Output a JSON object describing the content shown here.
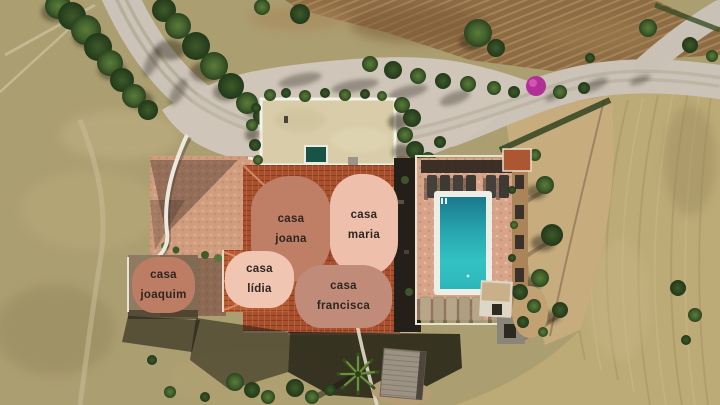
{
  "labels": [
    {
      "id": "casa-joana",
      "line1": "casa",
      "line2": "joana",
      "bg": "#bf7e66",
      "text_color": "#2e2620"
    },
    {
      "id": "casa-maria",
      "line1": "casa",
      "line2": "maria",
      "bg": "#eec0ac",
      "text_color": "#2e2620"
    },
    {
      "id": "casa-joaquim",
      "line1": "casa",
      "line2": "joaquim",
      "bg": "#bd7c64",
      "text_color": "#2e2620"
    },
    {
      "id": "casa-lidia",
      "line1": "casa",
      "line2": "lídia",
      "bg": "#f0c5b1",
      "text_color": "#2e2620"
    },
    {
      "id": "casa-francisca",
      "line1": "casa",
      "line2": "francisca",
      "bg": "#c18b79",
      "text_color": "#2e2620"
    }
  ],
  "colors": {
    "pool_water": "#2db0b5",
    "pool_deck": "#d7a48a",
    "roof_terracotta": "#a8502e",
    "dry_field": "#ab9e70",
    "plowed_field": "#8d6c44",
    "road": "#ccc3b8",
    "vegetation": "#42602d",
    "bougainvillea": "#b12f97",
    "label_dark_salmon": "#bf7e66",
    "label_light_pink": "#eec0ac"
  }
}
